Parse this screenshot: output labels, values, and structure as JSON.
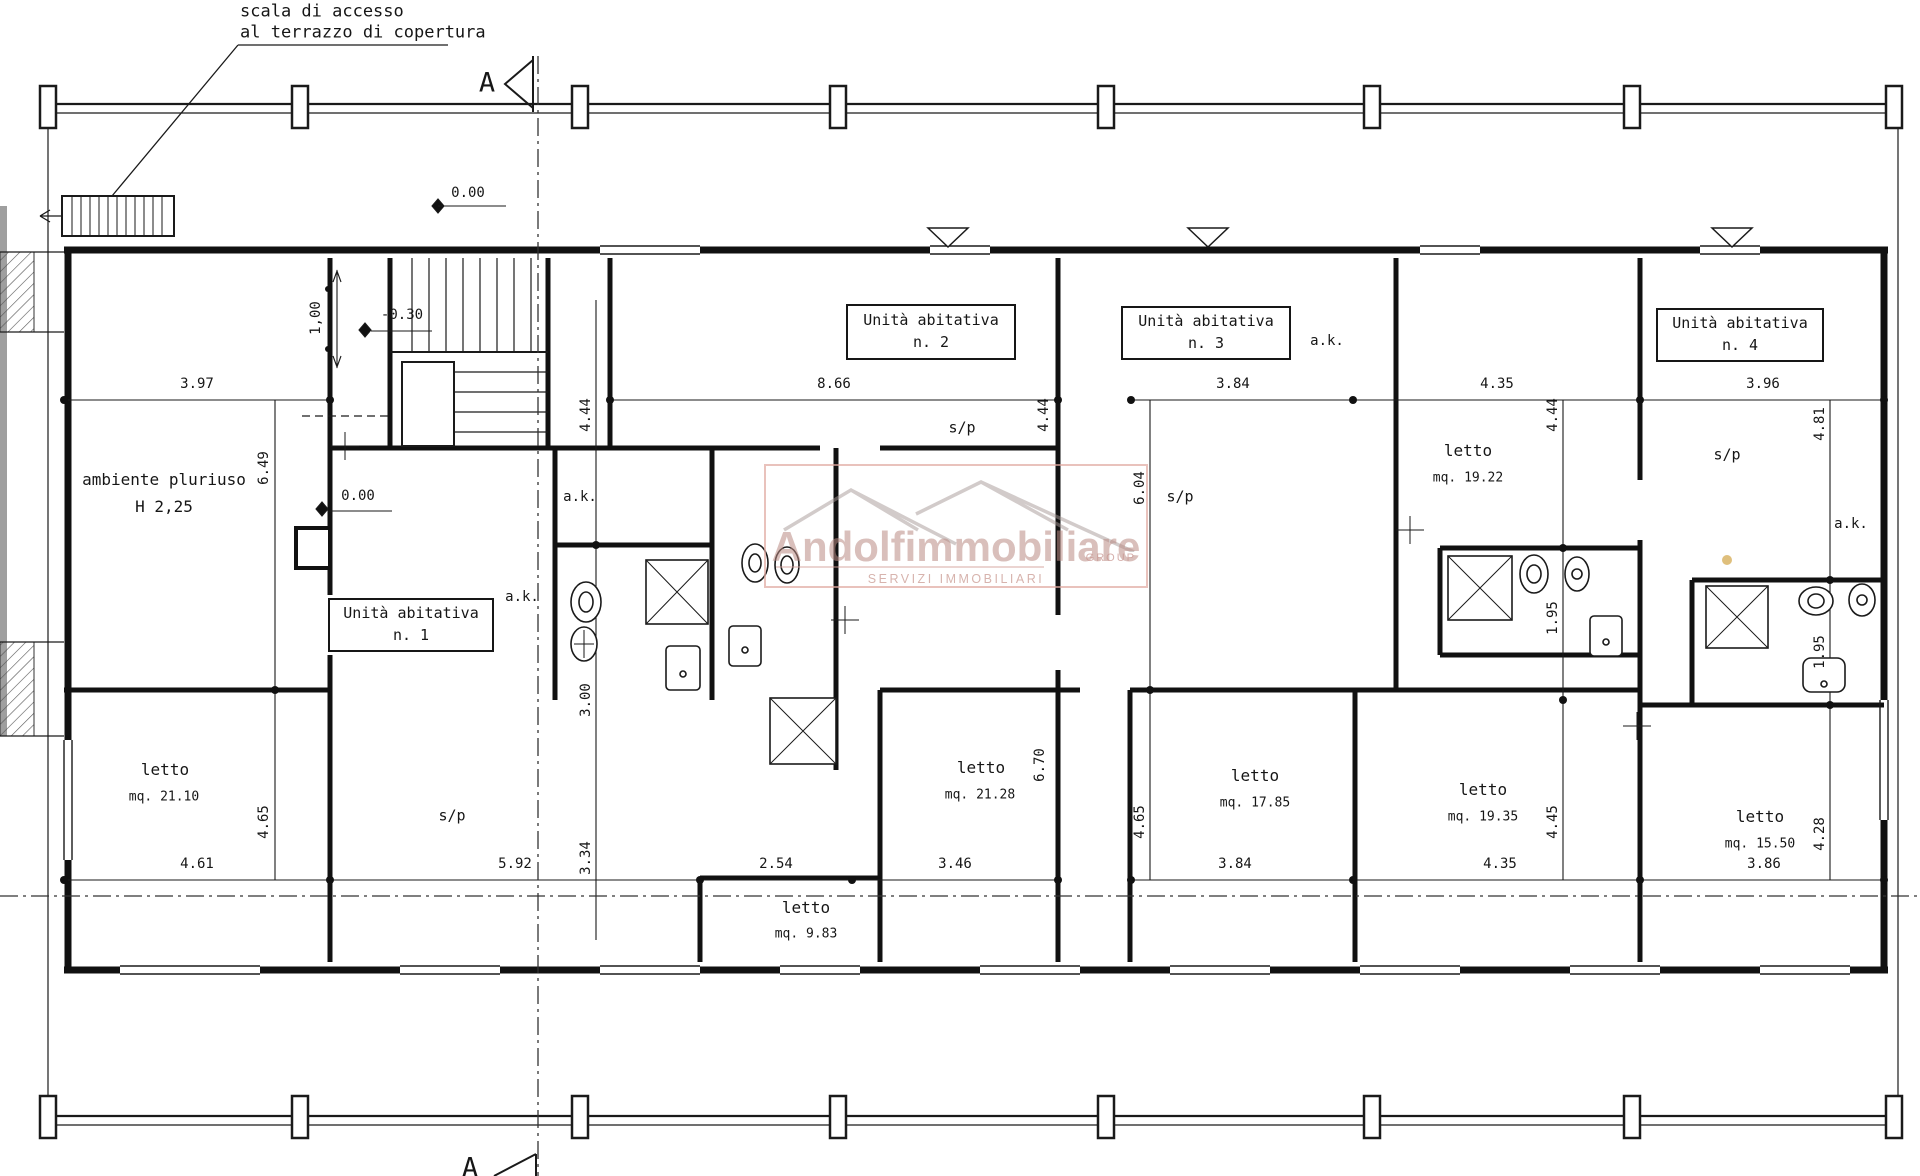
{
  "annotations": {
    "access_note_line1": "scala di accesso",
    "access_note_line2": "al terrazzo di copertura",
    "section_marker_top": "A",
    "section_marker_bottom": "A"
  },
  "elevations": {
    "ground_top": "0.00",
    "ground_stair": "0.00",
    "landing": "-0.30",
    "stair_width": "1,00"
  },
  "units": [
    {
      "label": "Unità abitativa",
      "number": "n. 1"
    },
    {
      "label": "Unità abitativa",
      "number": "n. 2"
    },
    {
      "label": "Unità abitativa",
      "number": "n. 3"
    },
    {
      "label": "Unità abitativa",
      "number": "n. 4"
    }
  ],
  "rooms": {
    "pluriuso": {
      "name": "ambiente pluriuso",
      "height": "H 2,25"
    },
    "letto_21_10": {
      "name": "letto",
      "area": "mq. 21.10"
    },
    "letto_21_28": {
      "name": "letto",
      "area": "mq. 21.28"
    },
    "letto_9_83": {
      "name": "letto",
      "area": "mq. 9.83"
    },
    "letto_17_85": {
      "name": "letto",
      "area": "mq. 17.85"
    },
    "letto_19_35": {
      "name": "letto",
      "area": "mq. 19.35"
    },
    "letto_15_50": {
      "name": "letto",
      "area": "mq. 15.50"
    },
    "letto_19_22": {
      "name": "letto",
      "area": "mq. 19.22"
    },
    "soggiorno_pranzo": "s/p",
    "angolo_cottura": "a.k."
  },
  "dimensions": {
    "top": {
      "d1": "3.97",
      "d2": "8.66",
      "d3": "3.84",
      "d4": "4.35",
      "d5": "3.96"
    },
    "bottom": {
      "d1": "4.61",
      "d2": "5.92",
      "d3": "2.54",
      "d4": "3.46",
      "d5": "3.84",
      "d6": "4.35",
      "d7": "3.86"
    },
    "vertical": {
      "left_upper": "6.49",
      "left_lower": "4.65",
      "u1_upper": "4.44",
      "u1_mid": "3.00",
      "u1_lower": "3.34",
      "u2_right": "4.44",
      "u2_lower": "6.70",
      "u3_left": "6.04",
      "u3_lower": "4.65",
      "u3_right": "4.44",
      "u3_bath": "1.95",
      "u3_right_lower": "4.45",
      "u4_right_upper": "4.81",
      "u4_bath": "1.95",
      "u4_right_lower": "4.28"
    }
  },
  "watermark": {
    "brand": "Andolfimmobiliare",
    "group": "GROUP",
    "tagline": "SERVIZI IMMOBILIARI"
  }
}
